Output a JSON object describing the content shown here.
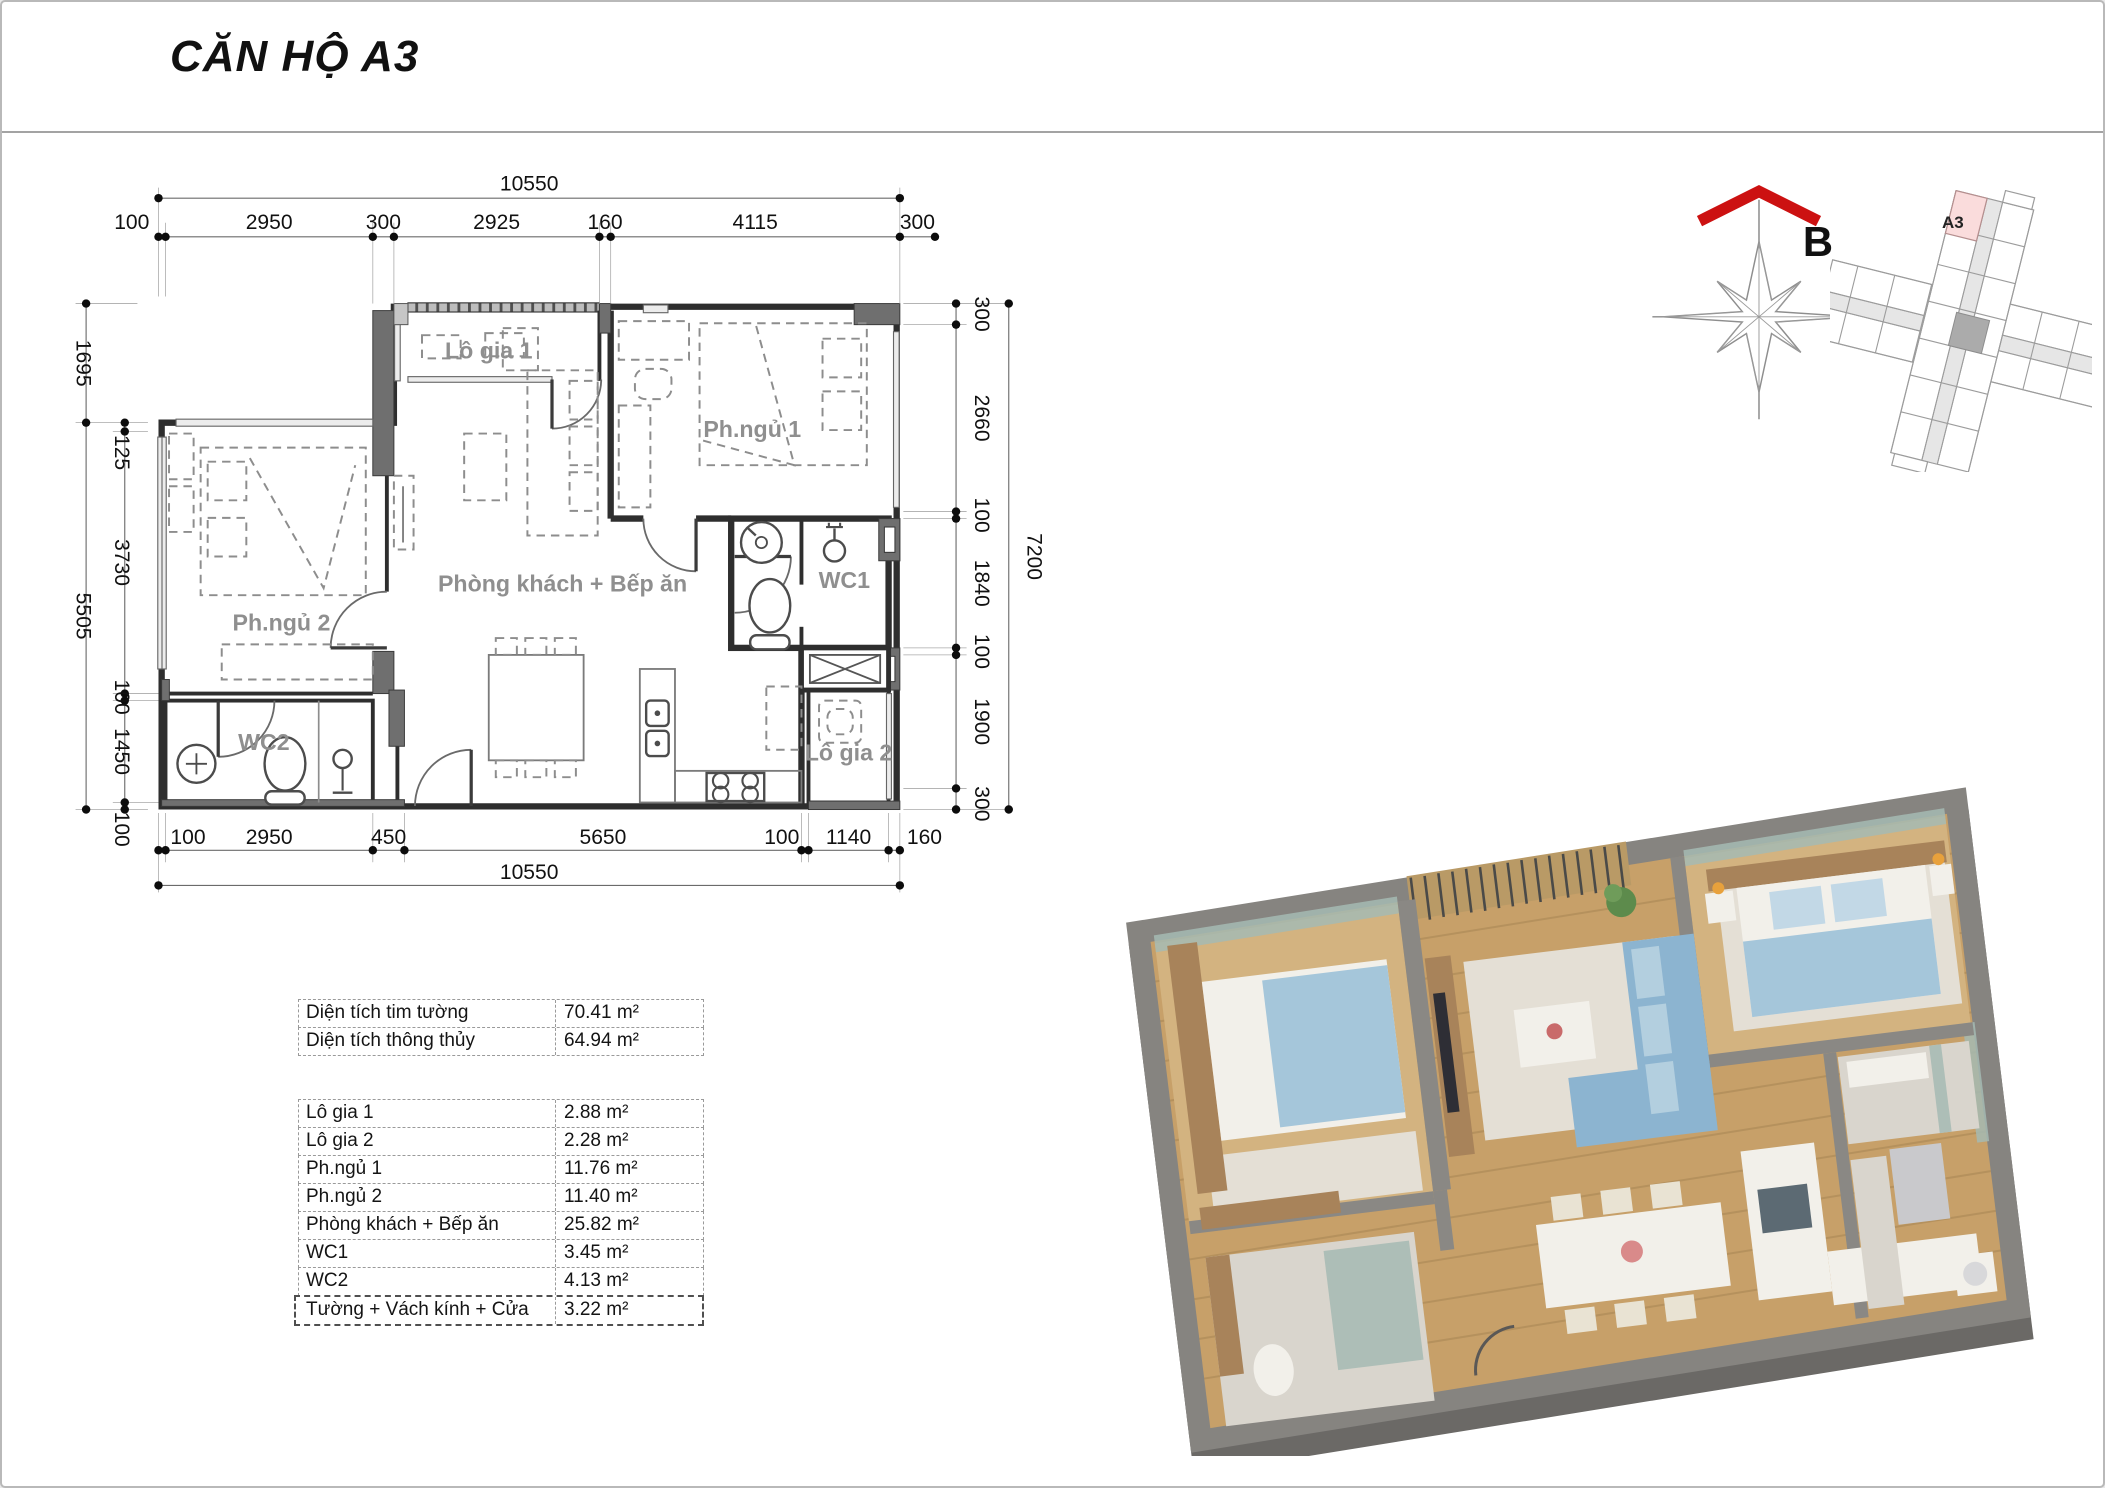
{
  "header": {
    "title": "CĂN HỘ A3"
  },
  "floor_plan": {
    "dims_top_total": "10550",
    "dims_top": [
      "100",
      "2950",
      "300",
      "2925",
      "160",
      "4115",
      "300"
    ],
    "dims_bottom": [
      "100",
      "2950",
      "450",
      "5650",
      "100",
      "1140",
      "160"
    ],
    "dims_bottom_total": "10550",
    "dims_left_outer": [
      "1695",
      "5505"
    ],
    "dims_left_inner": [
      "125",
      "3730",
      "100",
      "1450",
      "100"
    ],
    "dims_right": [
      "300",
      "2660",
      "100",
      "1840",
      "100",
      "1900",
      "300"
    ],
    "dims_right_total": "7200",
    "rooms": {
      "logia1": "Lô gia 1",
      "bedroom1": "Ph.ngủ 1",
      "bedroom2": "Ph.ngủ 2",
      "living": "Phòng khách + Bếp ăn",
      "wc1": "WC1",
      "wc2": "WC2",
      "logia2": "Lô gia 2"
    }
  },
  "compass": {
    "label": "B",
    "arrow_color": "#cc1111"
  },
  "key_plan": {
    "unit_label": "A3",
    "highlight_color": "#fadcdc"
  },
  "area_table": {
    "summary": [
      {
        "label": "Diện tích tim tường",
        "value": "70.41 m²"
      },
      {
        "label": "Diện tích thông thủy",
        "value": "64.94 m²"
      }
    ],
    "rooms": [
      {
        "label": "Lô gia 1",
        "value": "2.88 m²"
      },
      {
        "label": "Lô gia 2",
        "value": "2.28 m²"
      },
      {
        "label": "Ph.ngủ 1",
        "value": "11.76 m²"
      },
      {
        "label": "Ph.ngủ 2",
        "value": "11.40 m²"
      },
      {
        "label": "Phòng khách + Bếp ăn",
        "value": "25.82 m²"
      },
      {
        "label": "WC1",
        "value": "3.45 m²"
      },
      {
        "label": "WC2",
        "value": "4.13 m²"
      },
      {
        "label": "Tường + Vách kính + Cửa",
        "value": "3.22 m²"
      }
    ]
  },
  "render_3d": {
    "floor_wood_color": "#c7a069",
    "wall_color": "#868480",
    "sofa_color": "#8cb4d0",
    "bed_blanket_color": "#a5c6da"
  }
}
